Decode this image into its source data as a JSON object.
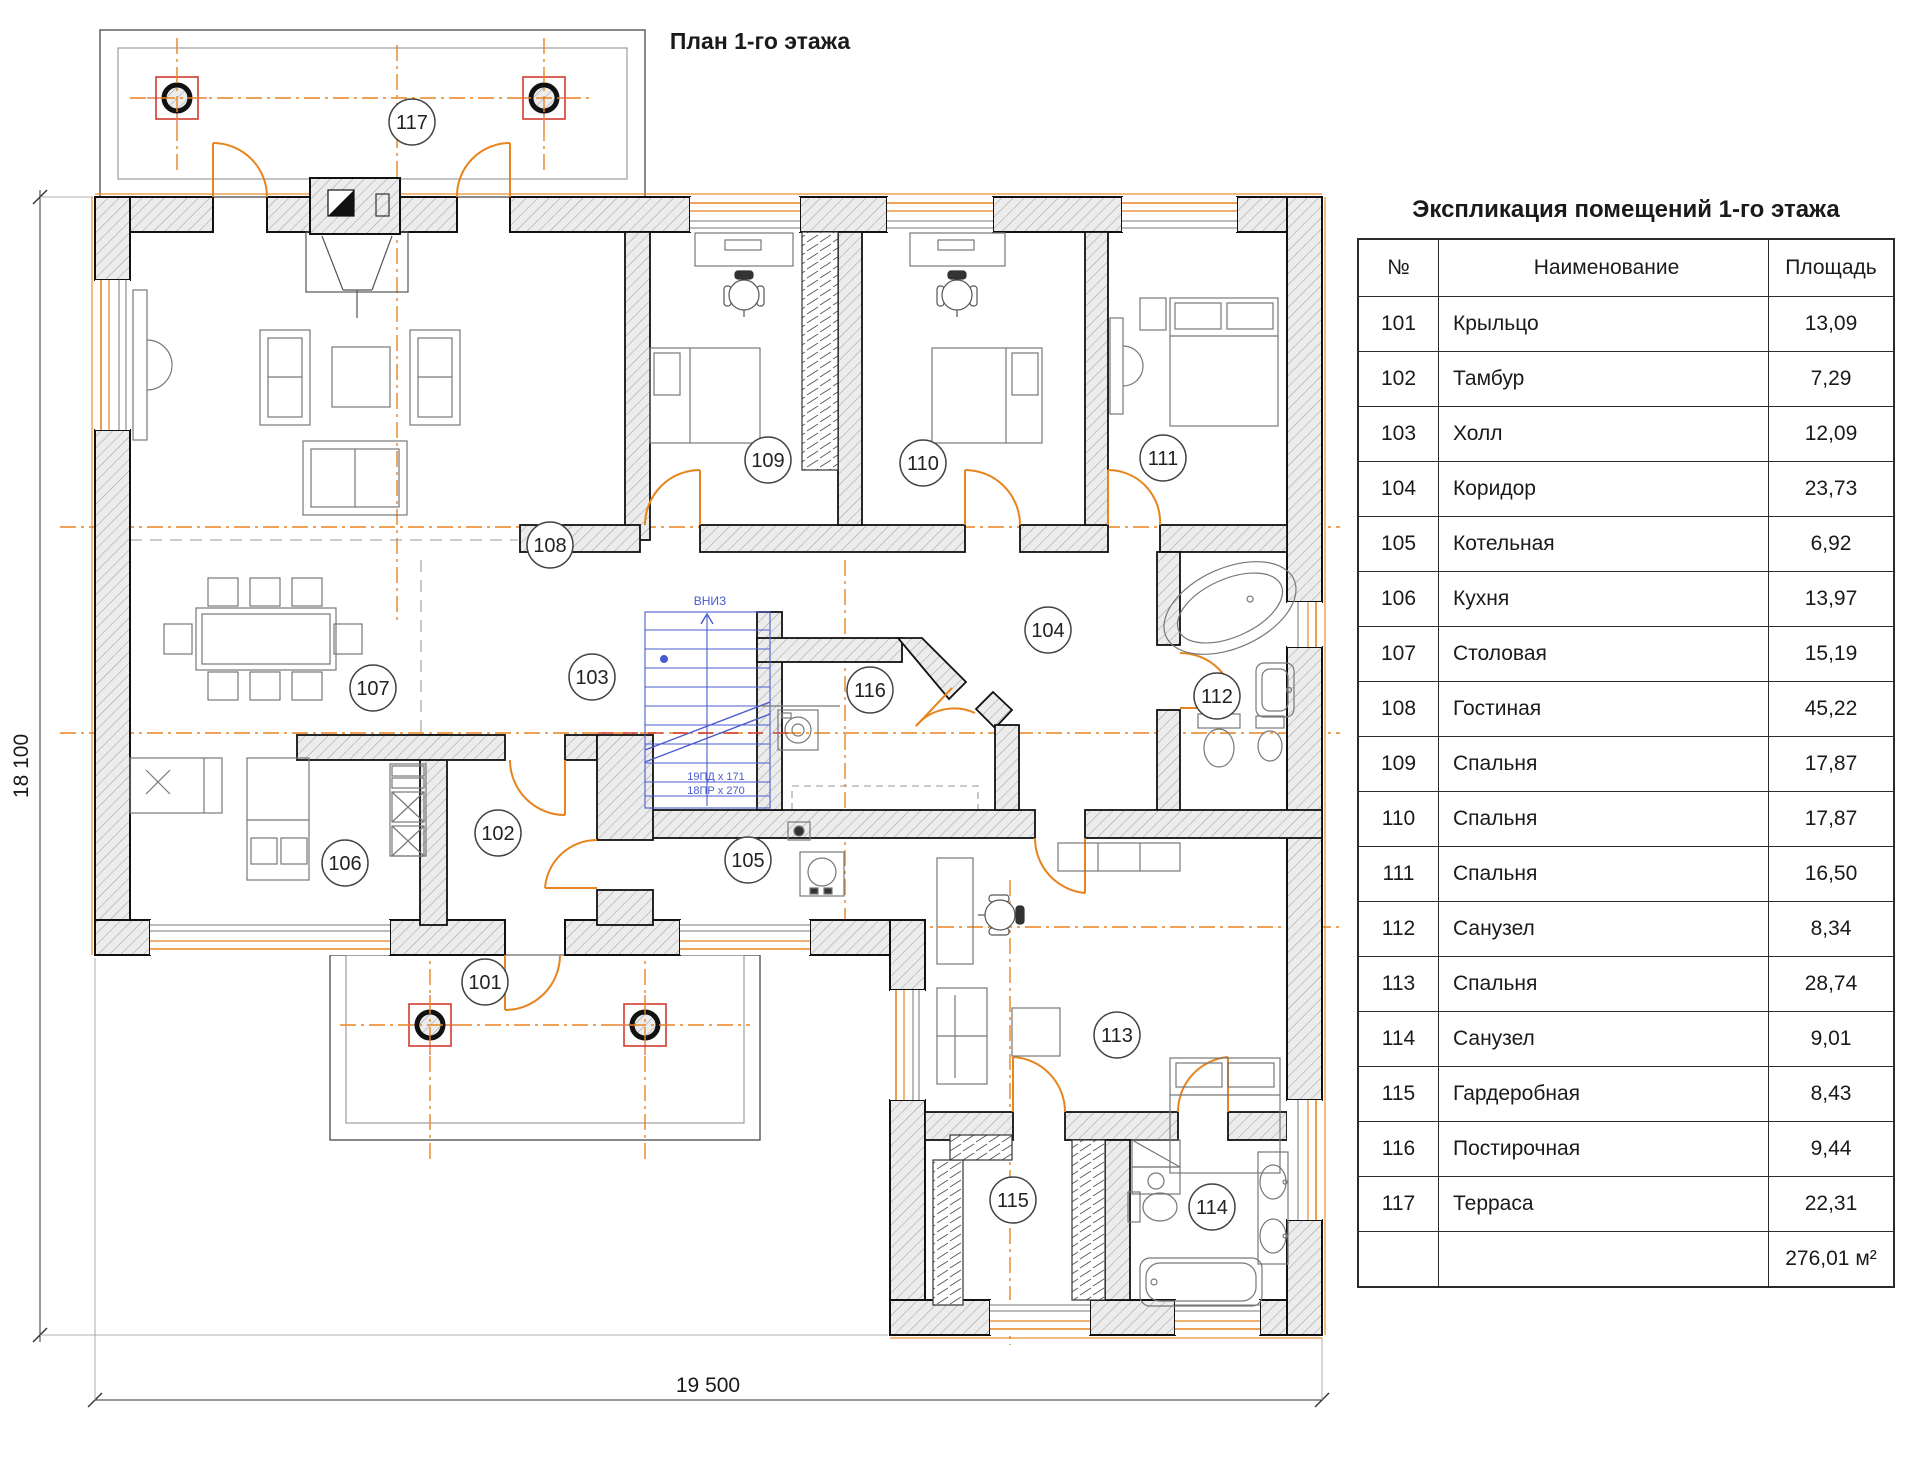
{
  "page": {
    "plan_title": "План 1-го этажа"
  },
  "dimensions": {
    "height_label": "18 100",
    "width_label": "19 500"
  },
  "stairs": {
    "down_label": "ВНИЗ",
    "tread_note_1": "19ПД х 171",
    "tread_note_2": "18ПР х 270"
  },
  "colors": {
    "accent_orange": "#e8841e",
    "axis_red": "#d23b2f",
    "stair_blue": "#4a5bd0",
    "wall_dark": "#111111"
  },
  "plan": {
    "rooms": [
      {
        "number": "101",
        "name": "Крыльцо"
      },
      {
        "number": "102",
        "name": "Тамбур"
      },
      {
        "number": "103",
        "name": "Холл"
      },
      {
        "number": "104",
        "name": "Коридор"
      },
      {
        "number": "105",
        "name": "Котельная"
      },
      {
        "number": "106",
        "name": "Кухня"
      },
      {
        "number": "107",
        "name": "Столовая"
      },
      {
        "number": "108",
        "name": "Гостиная"
      },
      {
        "number": "109",
        "name": "Спальня"
      },
      {
        "number": "110",
        "name": "Спальня"
      },
      {
        "number": "111",
        "name": "Спальня"
      },
      {
        "number": "112",
        "name": "Санузел"
      },
      {
        "number": "113",
        "name": "Спальня"
      },
      {
        "number": "114",
        "name": "Санузел"
      },
      {
        "number": "115",
        "name": "Гардеробная"
      },
      {
        "number": "116",
        "name": "Постирочная"
      },
      {
        "number": "117",
        "name": "Терраса"
      }
    ]
  },
  "table": {
    "title": "Экспликация помещений 1-го этажа",
    "headers": {
      "number": "№",
      "name": "Наименование",
      "area": "Площадь"
    },
    "rows": [
      {
        "number": "101",
        "name": "Крыльцо",
        "area": "13,09"
      },
      {
        "number": "102",
        "name": "Тамбур",
        "area": "7,29"
      },
      {
        "number": "103",
        "name": "Холл",
        "area": "12,09"
      },
      {
        "number": "104",
        "name": "Коридор",
        "area": "23,73"
      },
      {
        "number": "105",
        "name": "Котельная",
        "area": "6,92"
      },
      {
        "number": "106",
        "name": "Кухня",
        "area": "13,97"
      },
      {
        "number": "107",
        "name": "Столовая",
        "area": "15,19"
      },
      {
        "number": "108",
        "name": "Гостиная",
        "area": "45,22"
      },
      {
        "number": "109",
        "name": "Спальня",
        "area": "17,87"
      },
      {
        "number": "110",
        "name": "Спальня",
        "area": "17,87"
      },
      {
        "number": "111",
        "name": "Спальня",
        "area": "16,50"
      },
      {
        "number": "112",
        "name": "Санузел",
        "area": "8,34"
      },
      {
        "number": "113",
        "name": "Спальня",
        "area": "28,74"
      },
      {
        "number": "114",
        "name": "Санузел",
        "area": "9,01"
      },
      {
        "number": "115",
        "name": "Гардеробная",
        "area": "8,43"
      },
      {
        "number": "116",
        "name": "Постирочная",
        "area": "9,44"
      },
      {
        "number": "117",
        "name": "Терраса",
        "area": "22,31"
      }
    ],
    "total_area": "276,01 м²"
  }
}
